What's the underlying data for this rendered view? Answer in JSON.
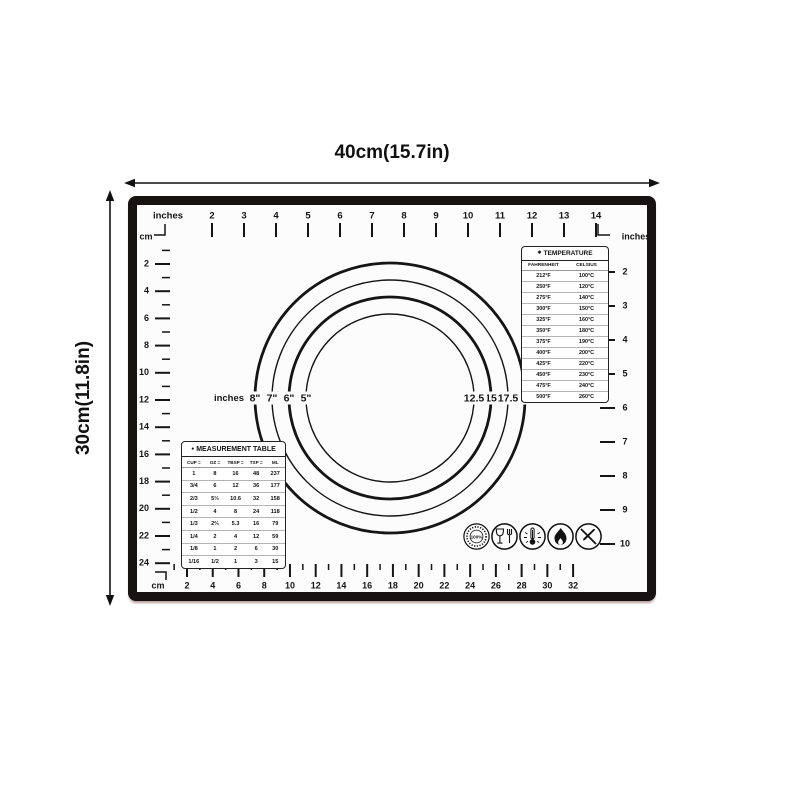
{
  "annotations": {
    "width_label": "40cm(15.7in)",
    "height_label": "30cm(11.8in)"
  },
  "mat": {
    "line_color": "#151515",
    "surface_color": "#fcfcfc",
    "rulers": {
      "top": {
        "unit": "inches",
        "corner_left": "cm",
        "corner_right": "inches",
        "numbers": [
          2,
          3,
          4,
          5,
          6,
          7,
          8,
          9,
          10,
          11,
          12,
          13,
          14
        ]
      },
      "left": {
        "min": 1,
        "max": 24,
        "labeled": [
          2,
          4,
          6,
          8,
          10,
          12,
          14,
          16,
          18,
          20,
          22,
          24
        ]
      },
      "right": {
        "numbers": [
          2,
          3,
          4,
          5,
          6,
          7,
          8,
          9,
          10
        ]
      },
      "bottom": {
        "unit": "cm",
        "min": 1,
        "max": 32,
        "labeled": [
          2,
          4,
          6,
          8,
          10,
          12,
          14,
          16,
          18,
          20,
          22,
          24,
          26,
          28,
          30,
          32
        ]
      }
    },
    "circles": {
      "left_unit": "inches",
      "right_unit": "cm",
      "rings": [
        {
          "inch": "8\"",
          "cm": "20",
          "radius": 135,
          "thick": true
        },
        {
          "inch": "7\"",
          "cm": "17.5",
          "radius": 118,
          "thick": false
        },
        {
          "inch": "6\"",
          "cm": "15",
          "radius": 101,
          "thick": true
        },
        {
          "inch": "5\"",
          "cm": "12.5",
          "radius": 84,
          "thick": false
        }
      ]
    },
    "temperature_table": {
      "icon": "✱",
      "title": "TEMPERATURE",
      "columns": [
        "FAHRENHEIT",
        "CELSIUS"
      ],
      "rows": [
        [
          "212°F",
          "100°C"
        ],
        [
          "250°F",
          "120°C"
        ],
        [
          "275°F",
          "140°C"
        ],
        [
          "300°F",
          "150°C"
        ],
        [
          "325°F",
          "160°C"
        ],
        [
          "350°F",
          "180°C"
        ],
        [
          "375°F",
          "190°C"
        ],
        [
          "400°F",
          "200°C"
        ],
        [
          "425°F",
          "220°C"
        ],
        [
          "450°F",
          "230°C"
        ],
        [
          "475°F",
          "240°C"
        ],
        [
          "500°F",
          "260°C"
        ]
      ]
    },
    "measurement_table": {
      "icon": "●",
      "title": "MEASUREMENT TABLE",
      "separator": "=",
      "columns": [
        "CUP",
        "OZ",
        "TBSP",
        "TSP",
        "ML"
      ],
      "rows": [
        [
          "1",
          "8",
          "16",
          "48",
          "237"
        ],
        [
          "3/4",
          "6",
          "12",
          "36",
          "177"
        ],
        [
          "2/3",
          "5⅓",
          "10.6",
          "32",
          "158"
        ],
        [
          "1/2",
          "4",
          "8",
          "24",
          "118"
        ],
        [
          "1/3",
          "2⅔",
          "5.3",
          "16",
          "79"
        ],
        [
          "1/4",
          "2",
          "4",
          "12",
          "59"
        ],
        [
          "1/8",
          "1",
          "2",
          "6",
          "30"
        ],
        [
          "1/16",
          "1/2",
          "1",
          "3",
          "15"
        ]
      ]
    },
    "badges": [
      {
        "name": "natural-100-silicone-badge",
        "text": "100%"
      },
      {
        "name": "food-safe-badge"
      },
      {
        "name": "heat-resistant-badge"
      },
      {
        "name": "flame-badge"
      },
      {
        "name": "no-cutting-badge"
      }
    ]
  }
}
